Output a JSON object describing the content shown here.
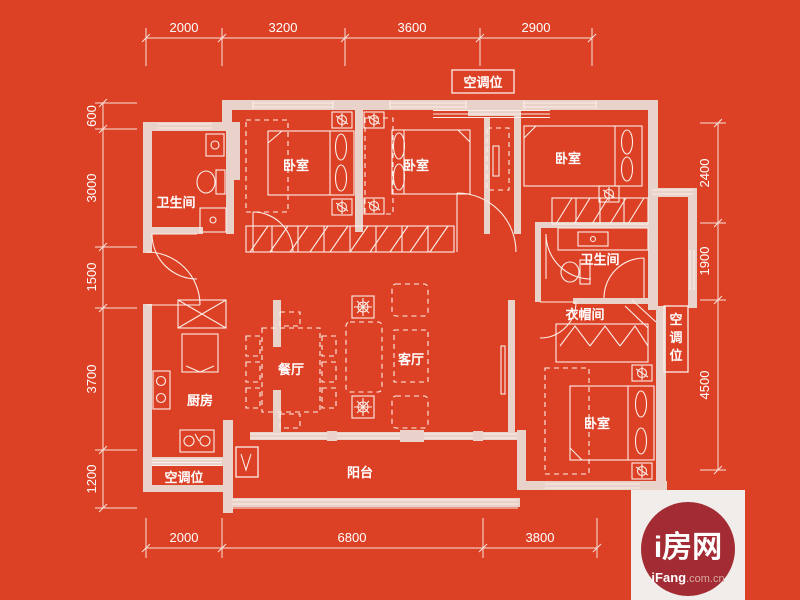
{
  "colors": {
    "background": "#dc4126",
    "wall": "#e9d2c9",
    "line": "#fbeee8",
    "logo_box": "#f0edeb",
    "logo_circle": "#a32b33",
    "text": "#ffffff"
  },
  "dimensions": {
    "top": [
      "2000",
      "3200",
      "3600",
      "2900"
    ],
    "left": [
      "600",
      "3000",
      "1500",
      "3700",
      "1200"
    ],
    "right": [
      "2400",
      "1900",
      "4500"
    ],
    "bottom": [
      "2000",
      "6800",
      "3800"
    ]
  },
  "rooms": {
    "bathroom_top_left": "卫生间",
    "bedroom_left": "卧室",
    "bedroom_middle": "卧室",
    "bedroom_right": "卧室",
    "bathroom_right": "卫生间",
    "cloakroom": "衣帽间",
    "bedroom_bottom": "卧室",
    "kitchen": "厨房",
    "dining": "餐厅",
    "living": "客厅",
    "balcony": "阳台"
  },
  "ac": {
    "top": "空调位",
    "right": "空调位",
    "bottom_left": "空调位"
  },
  "logo": {
    "title": "i房网",
    "brand": "iFang",
    "brand_suffix": ".com.cn"
  }
}
